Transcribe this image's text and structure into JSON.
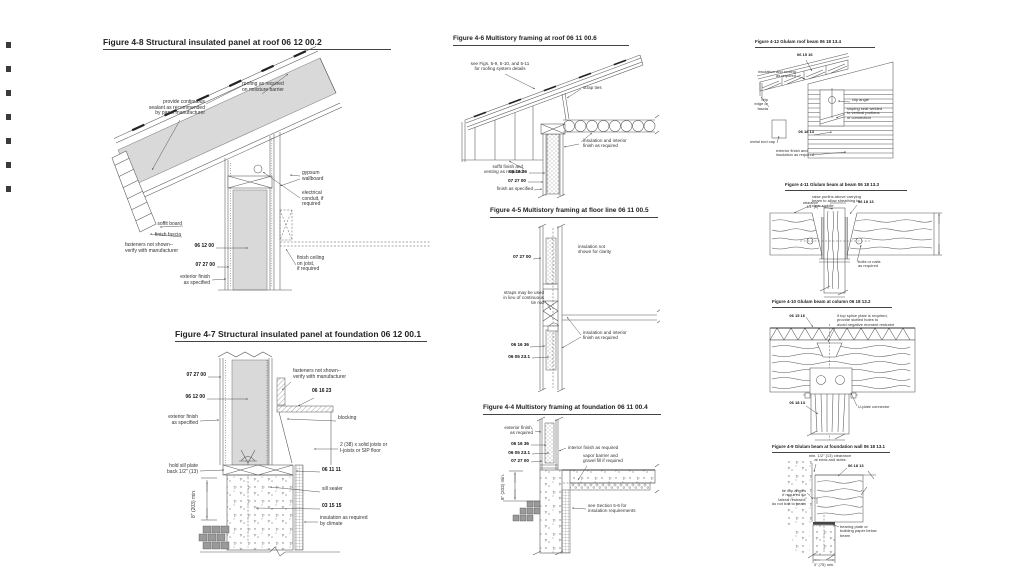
{
  "figures": {
    "f48": {
      "title": "Figure 4-8 Structural insulated panel at roof  06 12 00.2",
      "labels": {
        "roofing": "roofing as required\non moisture barrier",
        "sealant": "provide continuous\nsealant as recommended\nby panel manufacturer",
        "gypsum": "gypsum\nwallboard",
        "conduit": "electrical\nconduit, if\nrequired",
        "soffit": "soffit board",
        "fascia": "finish fascia",
        "fasteners": "fasteners not shown--\nverify with manufacturer",
        "code_sip": "06 12 00",
        "code_air": "07 27 00",
        "exterior": "exterior finish\nas specified",
        "ceiling": "finish ceiling\non joist,\nif required"
      }
    },
    "f47": {
      "title": "Figure 4-7 Structural insulated panel at foundation  06 12 00.1",
      "labels": {
        "code_air": "07 27 00",
        "code_sip": "06 12 00",
        "exterior": "exterior finish\nas specified",
        "fasteners": "fasteners not shown--\nverify with manufacturer",
        "code_sheathing": "06 16 23",
        "blocking": "blocking",
        "joists": "2 (38) x solid joists or\nI-joists or SIP floor",
        "sill_plate": "hold sill plate\nback 1/2\" (13)",
        "code_framing": "06 11 11",
        "sill_sealer": "sill sealer",
        "code_concrete": "03 15 15",
        "insulation": "insulation as required\nby climate",
        "dim": "8\" (203) min."
      }
    },
    "f46": {
      "title": "Figure 4-6 Multistory framing at roof  06 11 00.6",
      "labels": {
        "see_figs": "see Figs. 5-9, 5-10, and 5-11\nfor roofing system details",
        "strap_ties": "strap ties",
        "insulation": "insulation and interior\nfinish as required",
        "soffit": "soffit finish and\nventing as required",
        "code_sheathing": "06 16 36",
        "code_air": "07 27 00",
        "finish": "finish as specified"
      }
    },
    "f45": {
      "title": "Figure 4-5 Multistory framing at floor line  06 11 00.5",
      "labels": {
        "code_air": "07 27 00",
        "insulation_note": "insulation not\nshown for clarity",
        "straps": "straps may be used\nin lieu of continuous\ntie rod",
        "code_sheathing": "06 16 36",
        "code_anchor": "06 05 23.1",
        "insulation": "insulation and interior\nfinish as required"
      }
    },
    "f44": {
      "title": "Figure 4-4 Multistory framing at foundation  06 11 00.4",
      "labels": {
        "exterior": "exterior finish,\nas required",
        "code_sheathing": "06 16 36",
        "code_anchor": "06 05 23.1",
        "code_air": "07 27 00",
        "interior": "interior finish as required",
        "vapor": "vapor barrier and\ngravel fill if required",
        "section_note": "see Section 5-6 for\ninsulation requirements",
        "dim": "8\" (203) min."
      }
    },
    "f412": {
      "title": "Figure 4-12 Glulam roof beam  06 18 13.4",
      "labels": {
        "code_decking": "06 15 16",
        "insulation": "insulation and roofing\nas required",
        "drip_edge": "drip\nedge or\nfascia",
        "clip_angle": "clip angle",
        "sloping_seat": "sloping seat welded\nto vertical portions\nof connection",
        "code_glulam": "06 18 13",
        "end_cap": "metal end cap",
        "exterior": "exterior finish and\ninsulation as required"
      }
    },
    "f411": {
      "title": "Figure 4-11 Glulam beam at beam 06 18 13.3",
      "labels": {
        "raise_purlins": "raise purlins above carrying\nbeam to allow sheathing to\nclear saddle",
        "clearance": "clearance\n1/4\" (6)",
        "code_glulam": "06 18 13",
        "bolts": "bolts or nails\nas required"
      }
    },
    "f410": {
      "title": "Figure 4-10 Glulam beam at column  06 18 13.2",
      "labels": {
        "code_decking": "06 15 16",
        "splice_note": "if top splice plate is required,\nprovide slotted holes to\navoid negative moment restraint",
        "code_glulam": "06 18 13",
        "u_plate": "U-plate connector"
      }
    },
    "f49": {
      "title": "Figure 4-9 Glulam beam at foundation wall 06 18 13.1",
      "labels": {
        "clearance": "min. 1/2\" (13) clearance\nat ends and sides",
        "code_glulam": "06 18 13",
        "tie_clips": "tie clip angles\nif required for\nlateral restraint;\ndo not bolt to beam",
        "bearing": "bearing plate or\nbuilding paper below\nbeam",
        "dim": "3\" (75) min."
      }
    }
  }
}
